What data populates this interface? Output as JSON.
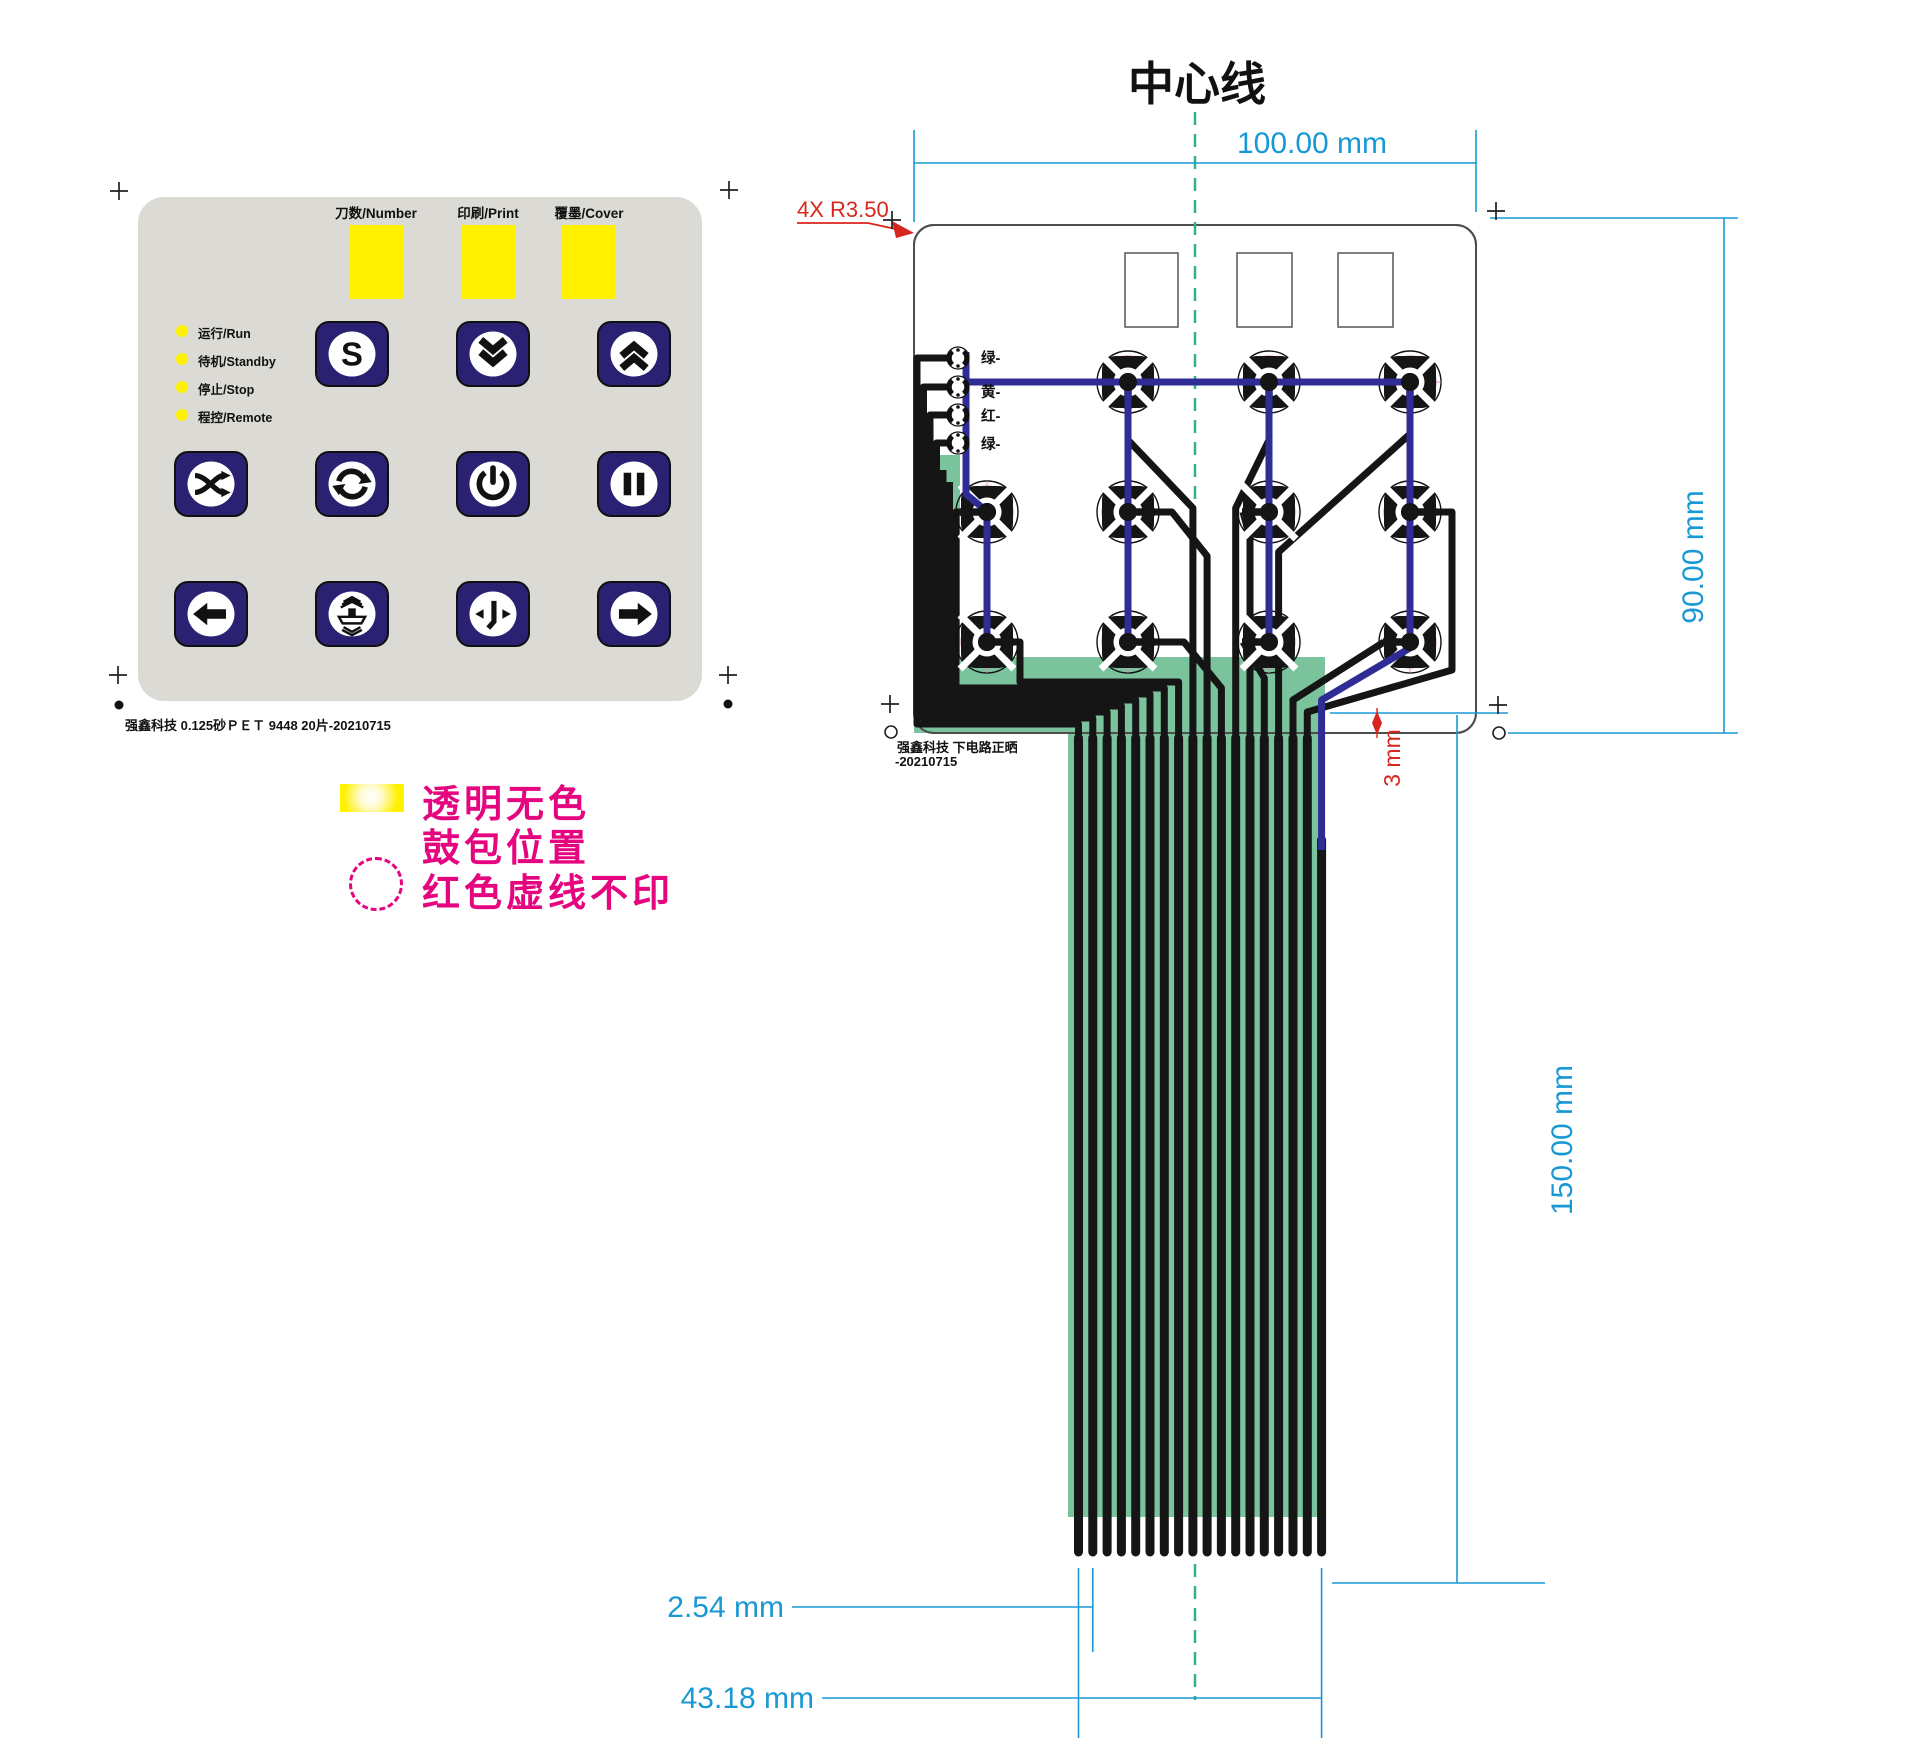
{
  "colors": {
    "accent_cyan": "#1899D5",
    "accent_red": "#D7261D",
    "magenta": "#E5057E",
    "yellow": "#FFF100",
    "navy_button": "#2A2172",
    "trace_blue": "#2F2C96",
    "flex_green": "#7AC39C",
    "panel_gray": "#DBDAD5",
    "centerline_green": "#34B17C"
  },
  "keypad": {
    "columns": [
      {
        "label": "刀数/Number"
      },
      {
        "label": "印刷/Print"
      },
      {
        "label": "覆墨/Cover"
      }
    ],
    "leds": [
      {
        "label": "运行/Run"
      },
      {
        "label": "待机/Standby"
      },
      {
        "label": "停止/Stop"
      },
      {
        "label": "程控/Remote"
      }
    ],
    "buttons": [
      "start-s",
      "scroll-down",
      "scroll-up",
      "shuffle",
      "cycle",
      "power",
      "pause",
      "arrow-left",
      "press",
      "jog",
      "arrow-right"
    ],
    "footer": "强鑫科技  0.125砂ＰＥＴ  9448  20片-20210715"
  },
  "legend": {
    "line1": "透明无色",
    "line2": "鼓包位置",
    "line3": "红色虚线不印"
  },
  "circuit": {
    "title": "中心线",
    "corner_note": "4X R3.50",
    "wire_labels": [
      "绿-",
      "黄-",
      "红-",
      "绿-"
    ],
    "footer_line1": "强鑫科技  下电路正晒",
    "footer_line2": "-20210715",
    "dims": {
      "width": "100.00 mm",
      "height": "90.00 mm",
      "tail_length": "150.00 mm",
      "finger_pitch": "2.54 mm",
      "tail_width": "43.18 mm",
      "edge_offset": "3 mm"
    }
  }
}
